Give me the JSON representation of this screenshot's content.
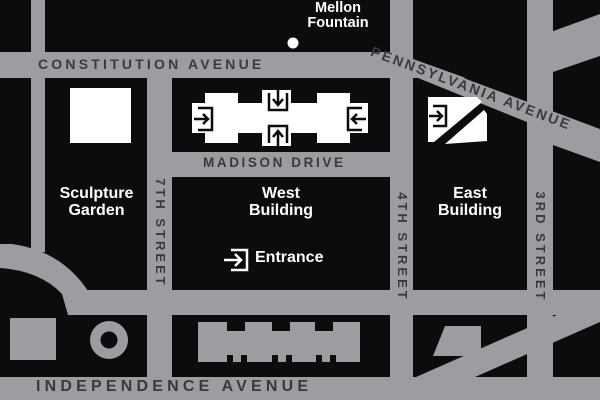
{
  "streets": {
    "constitution": "CONSTITUTION AVENUE",
    "pennsylvania": "PENNSYLVANIA AVENUE",
    "madison": "MADISON DRIVE",
    "independence": "INDEPENDENCE AVENUE",
    "seventh": "7TH STREET",
    "fourth": "4TH STREET",
    "third": "3RD STREET"
  },
  "places": {
    "mellon_fountain": "Mellon Fountain",
    "sculpture_garden": "Sculpture Garden",
    "west_building": "West Building",
    "east_building": "East Building",
    "entrance": "Entrance"
  },
  "icons": {
    "entrance_marker": "arrow-into-doorway",
    "fountain_marker": "white-dot"
  },
  "colors": {
    "road_gray": "#9b9da0",
    "block_black": "#0b0c0e",
    "building_white": "#ffffff",
    "road_text": "#3a3a3c",
    "place_text": "#ffffff"
  }
}
